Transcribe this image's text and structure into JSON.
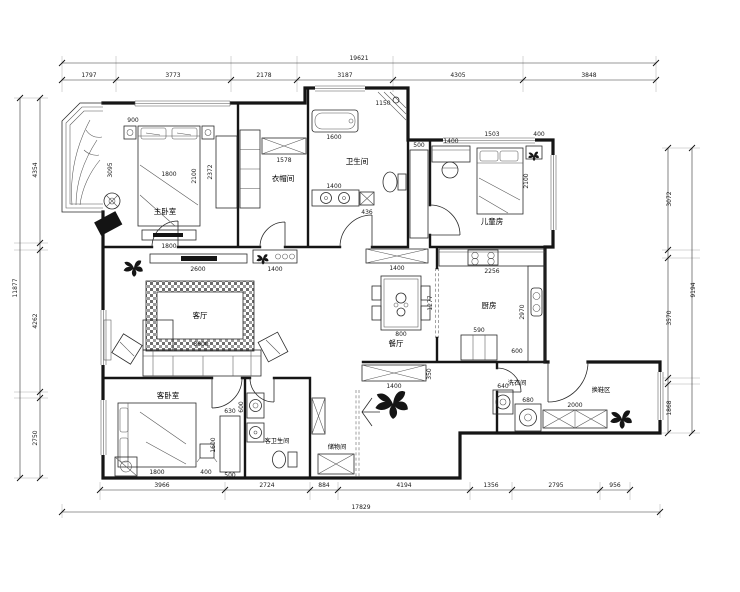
{
  "plan": {
    "rooms": {
      "master_bedroom": "主卧室",
      "cloakroom": "衣帽间",
      "bathroom": "卫生间",
      "kids_room": "儿童房",
      "living_room": "客厅",
      "dining_room": "餐厅",
      "kitchen": "厨房",
      "guest_bedroom": "客卧室",
      "guest_bathroom": "客卫生间",
      "storage_room": "储物间",
      "laundry_room": "洗衣间",
      "shoe_area": "换鞋区"
    },
    "dims": {
      "top": {
        "total": "19621",
        "segments": [
          "1797",
          "3773",
          "2178",
          "3187",
          "4305",
          "3848"
        ]
      },
      "bottom": {
        "total": "17829",
        "segments": [
          "3966",
          "2724",
          "884",
          "4194",
          "1356",
          "2795",
          "956"
        ]
      },
      "left": {
        "total": "11877",
        "segments": [
          "4354",
          "4262",
          "2750"
        ]
      },
      "right": {
        "total": "9194",
        "segments": [
          "3072",
          "3570",
          "1868"
        ]
      }
    },
    "inline_dims": {
      "master_bed_width": "1800",
      "master_bed_length": "2100",
      "master_nightstand": "900",
      "master_room_depth": "3095",
      "master_wardrobe": "2372",
      "master_tv": "1800",
      "cloak_shelf": "1578",
      "bath_tub": "1600",
      "bath_shower": "1150",
      "bath_vanity": "1400",
      "bath_vanity_depth": "436",
      "hall_cabinet": "500",
      "kids_top_a": "1503",
      "kids_top_b": "400",
      "kids_desk": "1400",
      "kids_bed": "2100",
      "living_tv": "2600",
      "living_sofa": "3600",
      "living_console": "1400",
      "dining_sideboard": "1400",
      "dining_table": "800",
      "kitchen_counter": "2256",
      "kitchen_depth": "2970",
      "kitchen_island": "590",
      "kitchen_door": "1277",
      "kitchen_sink": "600",
      "guest_bed": "1800",
      "guest_bench": "400",
      "guest_wardrobe_w": "630",
      "guest_wardrobe_h": "1600",
      "guest_wardrobe_d": "500",
      "guest_bath_washer": "600",
      "laundry_a": "640",
      "laundry_b": "680",
      "entry_cabinet": "1400",
      "entry_cabinet_depth": "350",
      "shoe_bench": "2000"
    }
  }
}
